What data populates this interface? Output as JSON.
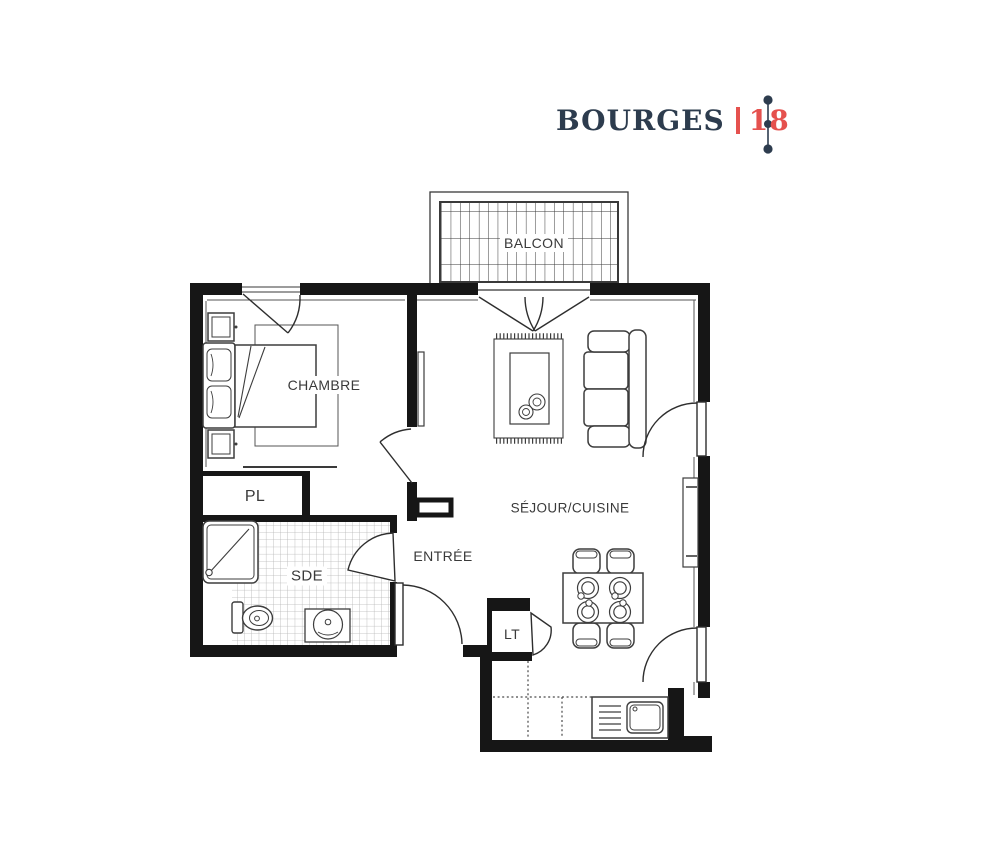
{
  "header": {
    "city": "BOURGES",
    "number": "18"
  },
  "labels": {
    "balcony": "BALCON",
    "bedroom": "CHAMBRE",
    "living_kitchen": "SÉJOUR/CUISINE",
    "entrance": "ENTRÉE",
    "closet": "PL",
    "shower_room": "SDE",
    "laundry_tech": "LT"
  },
  "colors": {
    "title": "#2d3c4e",
    "accent": "#e5514e",
    "wall": "#161616",
    "furniture_line": "#3d3d3d",
    "tile_line": "#b5b5b5"
  }
}
